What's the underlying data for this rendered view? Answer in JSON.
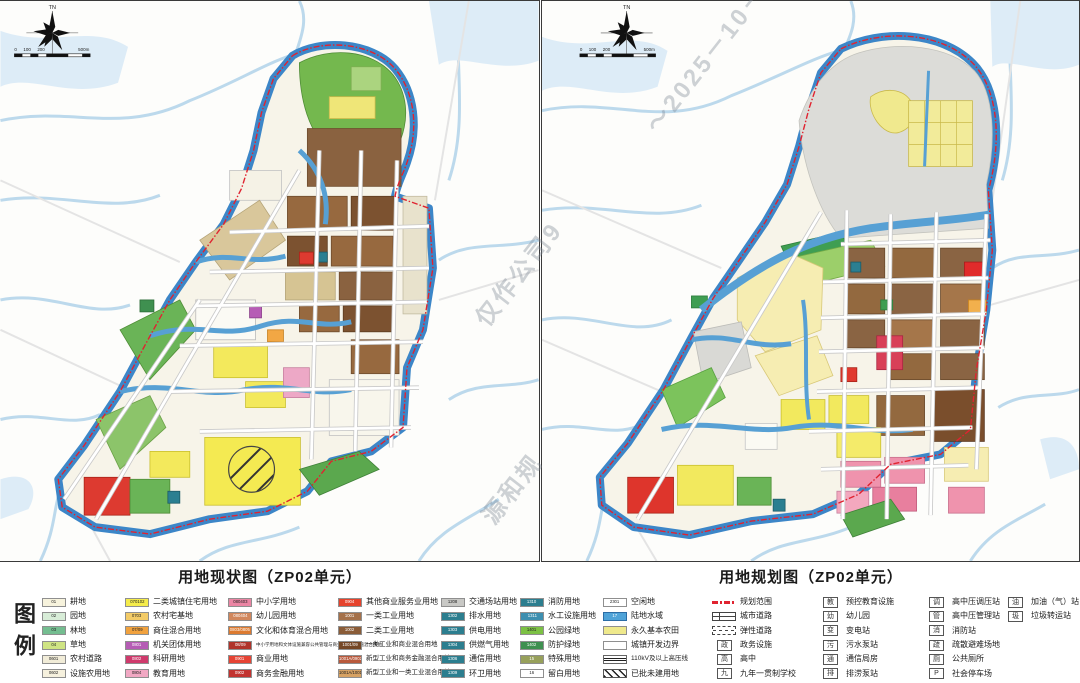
{
  "watermark": {
    "fragments": [
      "～2025－10－",
      "仅作公司9",
      "源和规"
    ]
  },
  "maps": {
    "current": {
      "title": "用地现状图（ZP02单元）",
      "compass_label": "TN",
      "scale_labels": [
        "0",
        "100",
        "200",
        "500m"
      ]
    },
    "planned": {
      "title": "用地规划图（ZP02单元）",
      "compass_label": "TN",
      "scale_labels": [
        "0",
        "100",
        "200",
        "500m"
      ]
    }
  },
  "legend": {
    "title": "图例",
    "columns": [
      {
        "items": [
          {
            "sw": "fill",
            "c": "#f7f3dd",
            "code": "01",
            "label": "耕地"
          },
          {
            "sw": "fill",
            "c": "#d8edd8",
            "code": "02",
            "label": "园地"
          },
          {
            "sw": "fill",
            "c": "#74bd90",
            "code": "03",
            "label": "林地"
          },
          {
            "sw": "fill",
            "c": "#cfe483",
            "code": "04",
            "label": "草地"
          },
          {
            "sw": "fill",
            "c": "#f1ecd8",
            "code": "0601",
            "label": "农村道路"
          },
          {
            "sw": "fill",
            "c": "#f6f1de",
            "code": "0602",
            "label": "设施农用地"
          }
        ]
      },
      {
        "items": [
          {
            "sw": "fill",
            "c": "#f5ec4b",
            "code": "070102",
            "label": "二类城镇住宅用地"
          },
          {
            "sw": "fill",
            "c": "#f3cb67",
            "code": "0703",
            "label": "农村宅基地"
          },
          {
            "sw": "fill",
            "c": "#f1a23e",
            "code": "07/09",
            "label": "商住混合用地"
          },
          {
            "sw": "fill dk",
            "c": "#b55cb4",
            "code": "0801",
            "label": "机关团体用地"
          },
          {
            "sw": "fill dk",
            "c": "#cf3a6c",
            "code": "0802",
            "label": "科研用地"
          },
          {
            "sw": "fill",
            "c": "#f1a8c3",
            "code": "0804",
            "label": "教育用地"
          }
        ]
      },
      {
        "items": [
          {
            "sw": "fill",
            "c": "#eb85a4",
            "code": "080403",
            "label": "中小学用地"
          },
          {
            "sw": "fill dk",
            "c": "#d1875d",
            "code": "080404",
            "label": "幼儿园用地"
          },
          {
            "sw": "fill dk",
            "c": "#dc7a30",
            "code": "0803/0805",
            "label": "文化和体育混合用地"
          },
          {
            "sw": "fill dk",
            "c": "#b0332a",
            "code": "08/09",
            "label": "中小学用地和文体设施兼容公共管理与商业服务业设施混合用地",
            "sz": "tiny"
          },
          {
            "sw": "fill dk",
            "c": "#e64334",
            "code": "0901",
            "label": "商业用地"
          },
          {
            "sw": "fill dk",
            "c": "#c23330",
            "code": "0902",
            "label": "商务金融用地"
          }
        ]
      },
      {
        "items": [
          {
            "sw": "fill dk",
            "c": "#e6432d",
            "code": "0904",
            "label": "其他商业服务业用地"
          },
          {
            "sw": "fill dk",
            "c": "#a5714a",
            "code": "1001",
            "label": "一类工业用地"
          },
          {
            "sw": "fill dk",
            "c": "#8a5c38",
            "code": "1002",
            "label": "二类工业用地"
          },
          {
            "sw": "fill dk",
            "c": "#744726",
            "code": "1001/09",
            "label": "一类工业和商业混合用地",
            "sz": "sm"
          },
          {
            "sw": "fill dk",
            "c": "#b8593c",
            "code": "1001A/0902",
            "label": "新型工业和商务金融混合用地",
            "sz": "sm"
          },
          {
            "sw": "fill",
            "c": "#d7a263",
            "code": "1001A/1001",
            "label": "新型工业和一类工业混合用地",
            "sz": "sm"
          }
        ]
      },
      {
        "items": [
          {
            "sw": "fill",
            "c": "#c8c8c5",
            "code": "1208",
            "label": "交通场站用地"
          },
          {
            "sw": "fill dk",
            "c": "#2c7e8f",
            "code": "1302",
            "label": "排水用地"
          },
          {
            "sw": "fill dk",
            "c": "#2c7e8f",
            "code": "1303",
            "label": "供电用地"
          },
          {
            "sw": "fill dk",
            "c": "#2c7e8f",
            "code": "1304",
            "label": "供燃气用地"
          },
          {
            "sw": "fill dk",
            "c": "#2c7e8f",
            "code": "1306",
            "label": "通信用地"
          },
          {
            "sw": "fill dk",
            "c": "#2c7e8f",
            "code": "1309",
            "label": "环卫用地"
          }
        ]
      },
      {
        "items": [
          {
            "sw": "fill dk",
            "c": "#2c7e8f",
            "code": "1310",
            "label": "消防用地"
          },
          {
            "sw": "fill dk",
            "c": "#3d8fb0",
            "code": "1311",
            "label": "水工设施用地"
          },
          {
            "sw": "fill",
            "c": "#7cc144",
            "code": "1401",
            "label": "公园绿地"
          },
          {
            "sw": "fill dk",
            "c": "#3f9050",
            "code": "1402",
            "label": "防护绿地"
          },
          {
            "sw": "fill dk",
            "c": "#97a05b",
            "code": "15",
            "label": "特殊用地"
          },
          {
            "sw": "fill",
            "c": "#ffffff",
            "code": "16",
            "label": "留白用地"
          }
        ]
      },
      {
        "items": [
          {
            "sw": "fill",
            "c": "#ffffff",
            "code": "2301",
            "label": "空闲地"
          },
          {
            "sw": "fill dk water",
            "c": "#4fa3d8",
            "code": "17",
            "label": "陆地水域"
          },
          {
            "sw": "fill",
            "c": "#efe98c",
            "code": "",
            "label": "永久基本农田"
          },
          {
            "sw": "fill",
            "c": "#ffffff",
            "code": "",
            "label": "城镇开发边界"
          },
          {
            "sw": "power",
            "label": "110kV及以上高压线",
            "sz": "sm"
          },
          {
            "sw": "hatch",
            "label": "已批未建用地"
          }
        ]
      },
      {
        "items": [
          {
            "sw": "boundary",
            "label": "规划范围"
          },
          {
            "sw": "road",
            "label": "城市道路"
          },
          {
            "sw": "roaddash",
            "label": "弹性道路"
          },
          {
            "sw": "box",
            "g": "政",
            "label": "政务设施"
          },
          {
            "sw": "box",
            "g": "高",
            "label": "高中"
          },
          {
            "sw": "box",
            "g": "九",
            "label": "九年一贯制学校"
          }
        ]
      },
      {
        "items": [
          {
            "sw": "box",
            "g": "教",
            "label": "预控教育设施"
          },
          {
            "sw": "box",
            "g": "幼",
            "label": "幼儿园"
          },
          {
            "sw": "box",
            "g": "变",
            "label": "变电站"
          },
          {
            "sw": "box",
            "g": "污",
            "label": "污水泵站"
          },
          {
            "sw": "box",
            "g": "通",
            "label": "通信局房"
          },
          {
            "sw": "box",
            "g": "排",
            "label": "排涝泵站"
          }
        ]
      },
      {
        "items": [
          {
            "sw": "box",
            "g": "调",
            "label": "高中压调压站"
          },
          {
            "sw": "box",
            "g": "管",
            "label": "高中压管理站"
          },
          {
            "sw": "box",
            "g": "消",
            "label": "消防站"
          },
          {
            "sw": "box",
            "g": "疏",
            "label": "疏散避难场地"
          },
          {
            "sw": "box",
            "g": "厕",
            "label": "公共厕所"
          },
          {
            "sw": "box",
            "g": "P",
            "label": "社会停车场"
          }
        ]
      },
      {
        "items": [
          {
            "sw": "box",
            "g": "油",
            "label": "加油（气）站"
          },
          {
            "sw": "box",
            "g": "圾",
            "label": "垃圾转运站"
          }
        ]
      }
    ]
  }
}
